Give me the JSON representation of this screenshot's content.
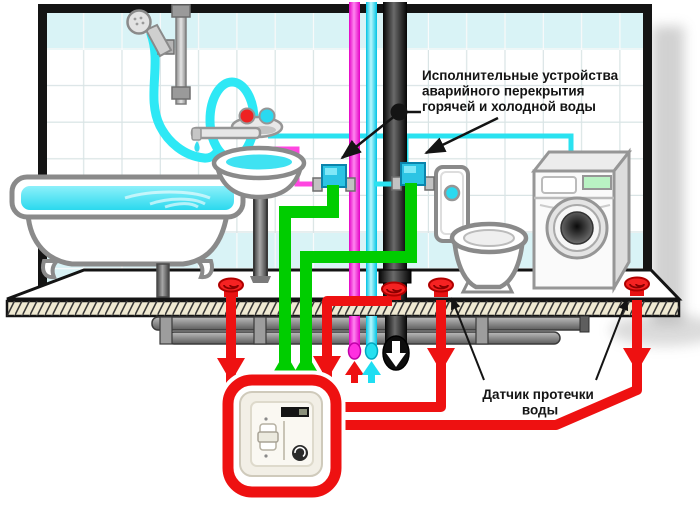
{
  "diagram": {
    "annotation_actuators": {
      "line1": "Исполнительные устройства",
      "line2": "аварийного  перекрытия",
      "line3": "горячей и холодной воды"
    },
    "annotation_sensor": {
      "line1": "Датчик протечки",
      "line2": "воды"
    },
    "colors": {
      "hot_water": "#ff1ed9",
      "cold_water": "#1fdef2",
      "control_pipe_green": "#00cd00",
      "alarm_red": "#ee1111",
      "tile_accent": "#d9f3f6",
      "sewer_dark": "#1c1c1c",
      "annotation_black": "#141414"
    }
  }
}
